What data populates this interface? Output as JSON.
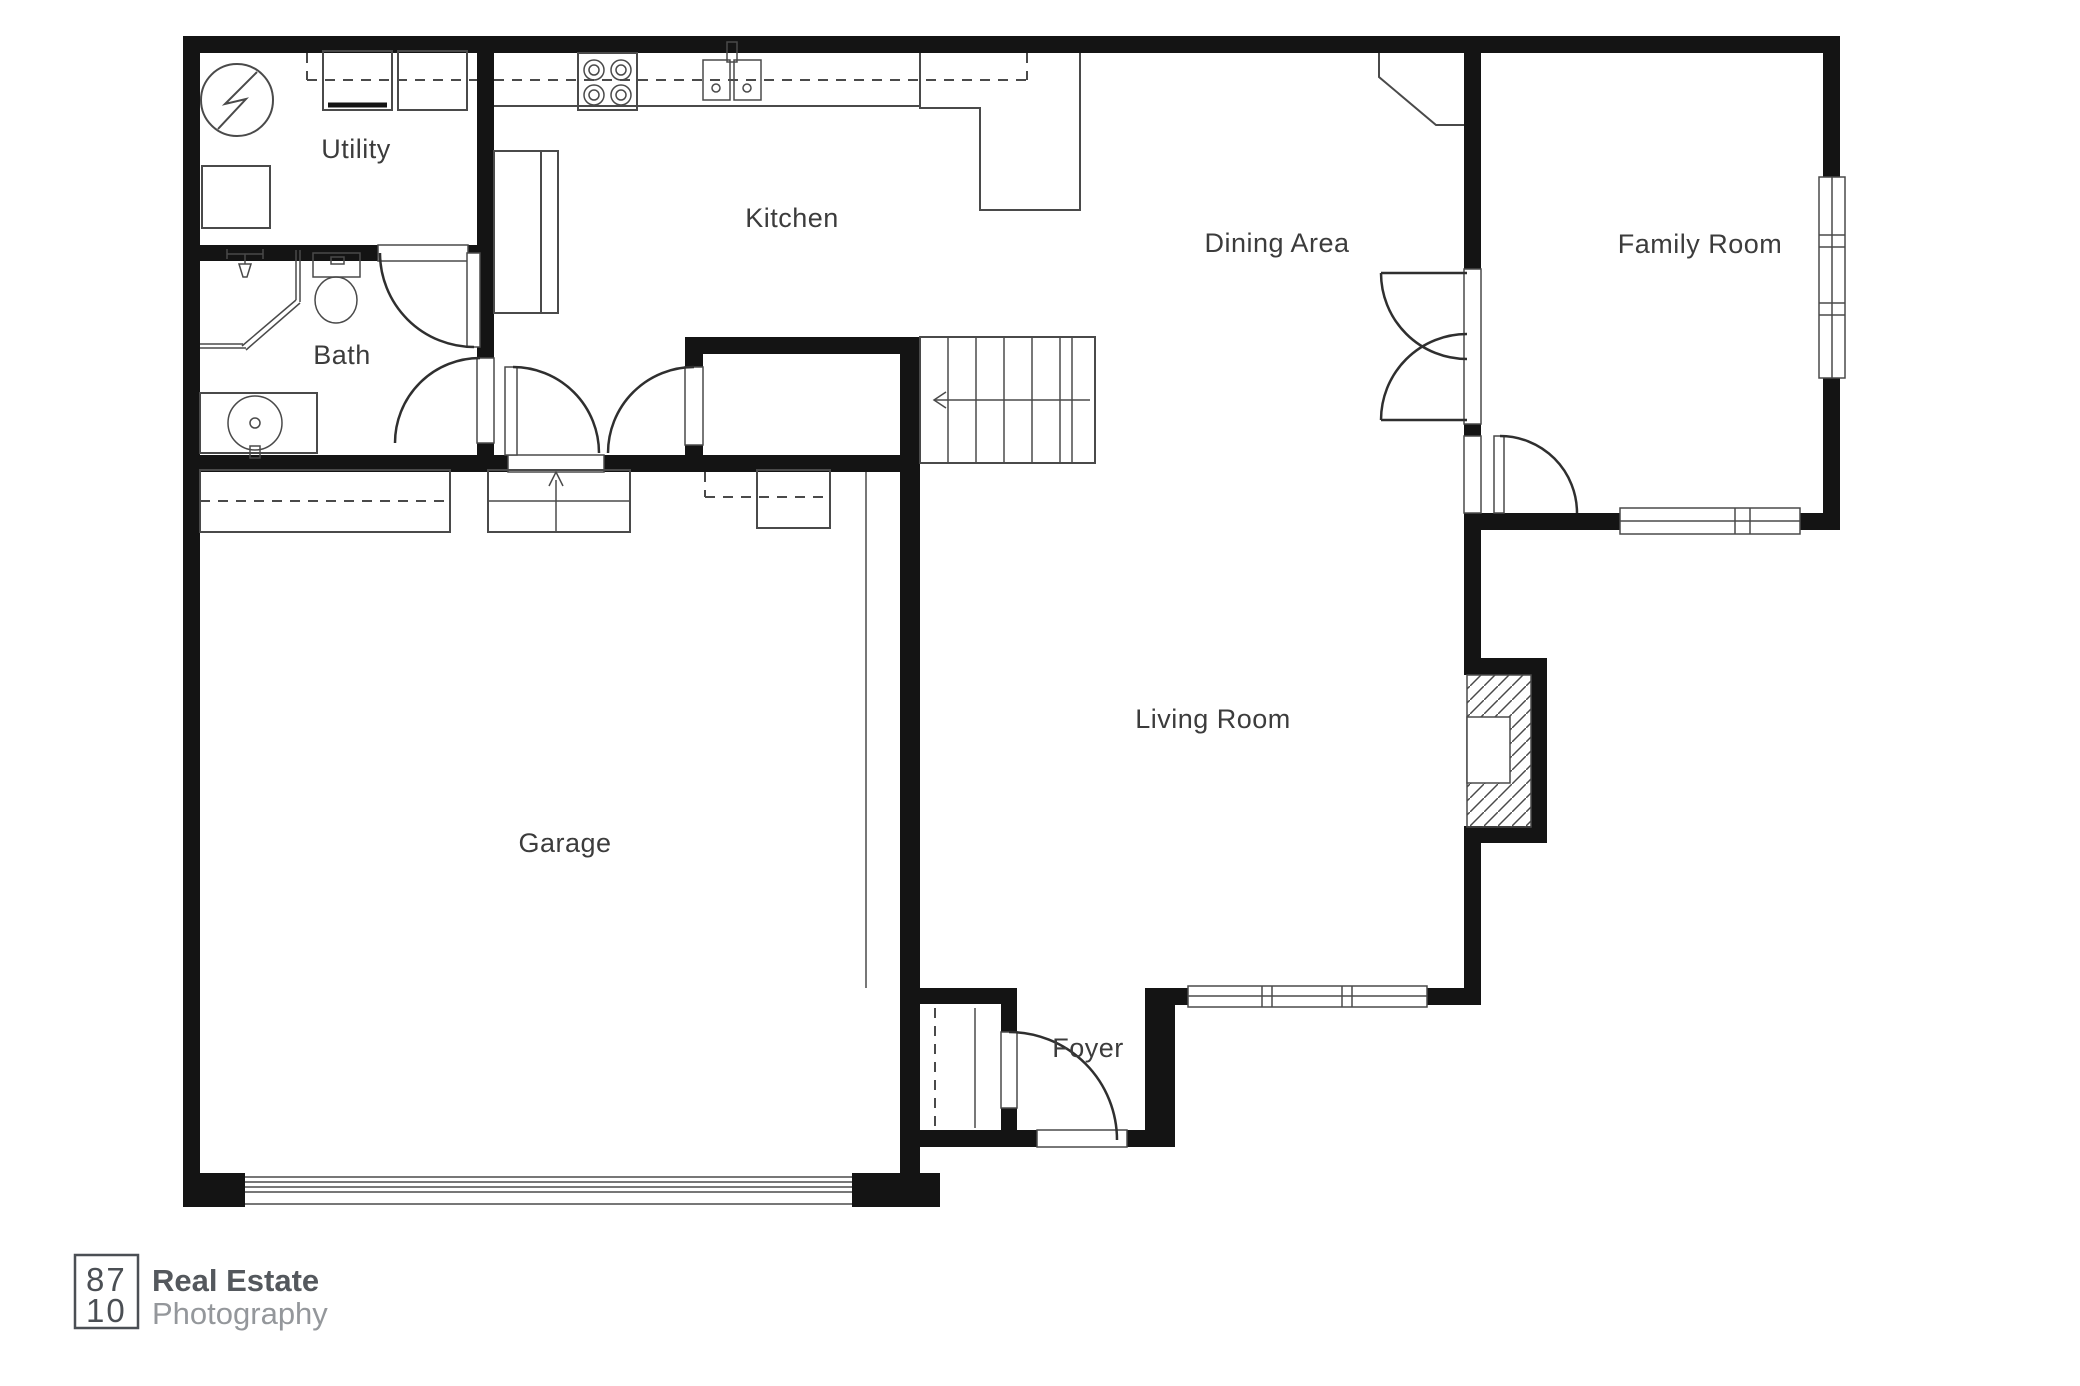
{
  "title": "First floor plan",
  "colors": {
    "background": "#ffffff",
    "wall": "#141414",
    "thin_line": "#4a4a4a",
    "door_arc": "#2f2f2f",
    "label_text": "#3c3c3c",
    "logo_box": "#4b4f54",
    "logo_title": "#54585d",
    "logo_subtitle": "#94979b"
  },
  "rooms": {
    "utility": {
      "label": "Utility"
    },
    "kitchen": {
      "label": "Kitchen"
    },
    "dining": {
      "label": "Dining Area"
    },
    "family": {
      "label": "Family Room"
    },
    "bath": {
      "label": "Bath"
    },
    "garage": {
      "label": "Garage"
    },
    "living": {
      "label": "Living Room"
    },
    "foyer": {
      "label": "Foyer"
    }
  },
  "fixtures": [
    "water-heater",
    "washer",
    "dryer",
    "utility-counter",
    "refrigerator",
    "stove-burners",
    "double-sink",
    "upper-cabinets-dashed",
    "kitchen-peninsula",
    "corner-cabinet",
    "shower",
    "toilet",
    "vanity-sink",
    "staircase-up-arrow-left",
    "garage-entry-steps-up-arrow",
    "fireplace-hatched",
    "coat-closet",
    "garage-door",
    "front-door",
    "french-doors",
    "windows-family-right",
    "windows-family-bottom",
    "windows-living-bottom"
  ],
  "logo": {
    "number_top": "87",
    "number_bottom": "10",
    "title": "Real Estate",
    "subtitle": "Photography"
  }
}
